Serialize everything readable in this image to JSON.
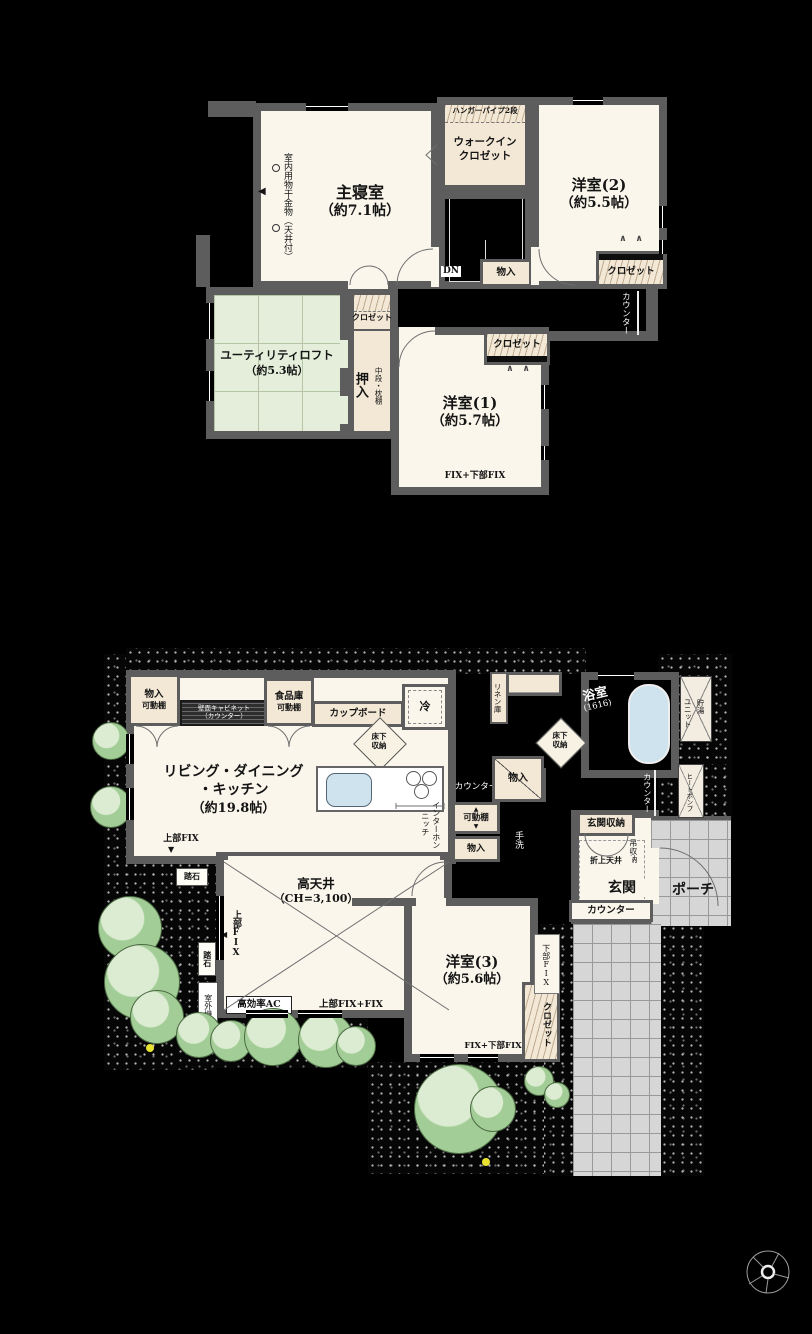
{
  "common": {
    "closet": "クロゼット",
    "storage": "物入",
    "counter": "カウンター",
    "shelf": "可動棚",
    "underfloor_1": "床下",
    "underfloor_2": "収納",
    "fix_lower": "FIX+下部FIX",
    "step_stone": "踏石",
    "upper_fix": "上部FIX",
    "dn": "DN"
  },
  "icons": {
    "left_marker": "◀",
    "down_marker": "▼",
    "up_marker": "▲",
    "fold_marks": "∧　∧"
  },
  "f2": {
    "master_name": "主寝室",
    "master_size": "（約7.1帖）",
    "drying": "室内用物干金物（天井付）",
    "wic_1": "ウォークイン",
    "wic_2": "クロゼット",
    "hanger": "ハンガーパイプ2段",
    "room2_name": "洋室(2)",
    "room2_size": "（約5.5帖）",
    "utility_name": "ユーティリティロフト",
    "utility_size": "（約5.3帖）",
    "oshiire": "押入",
    "chudan": "中段・枕棚",
    "room1_name": "洋室(1)",
    "room1_size": "（約5.7帖）"
  },
  "f1": {
    "ldk_1": "リビング・ダイニング",
    "ldk_2": "・キッチン",
    "ldk_size": "（約19.8帖）",
    "cabinet_1": "壁面キャビネット",
    "cabinet_2": "（カウンター）",
    "pantry": "食品庫",
    "cupboard": "カップボード",
    "fridge": "冷",
    "intercom_1": "インターホン",
    "intercom_2": "ニッチ",
    "handwash": "手洗",
    "linen": "リネン庫",
    "bath_name": "浴室",
    "bath_size": "(1616)",
    "tank_1": "貯湯",
    "tank_2": "ユニット",
    "heatpump": "ヒートポンプ",
    "entry_storage": "玄関収納",
    "hanging_storage": "吊収納",
    "coffered_ceiling": "折上天井",
    "entrance": "玄関",
    "porch": "ポーチ",
    "room3_name": "洋室(3)",
    "room3_size": "（約5.6帖）",
    "lower_fix": "下部FIX",
    "high_ceiling_1": "高天井",
    "high_ceiling_2": "（CH=3,100）",
    "ac": "高効率AC",
    "upper_fix_fix": "上部FIX+FIX",
    "outdoor_unit": "室外機"
  }
}
